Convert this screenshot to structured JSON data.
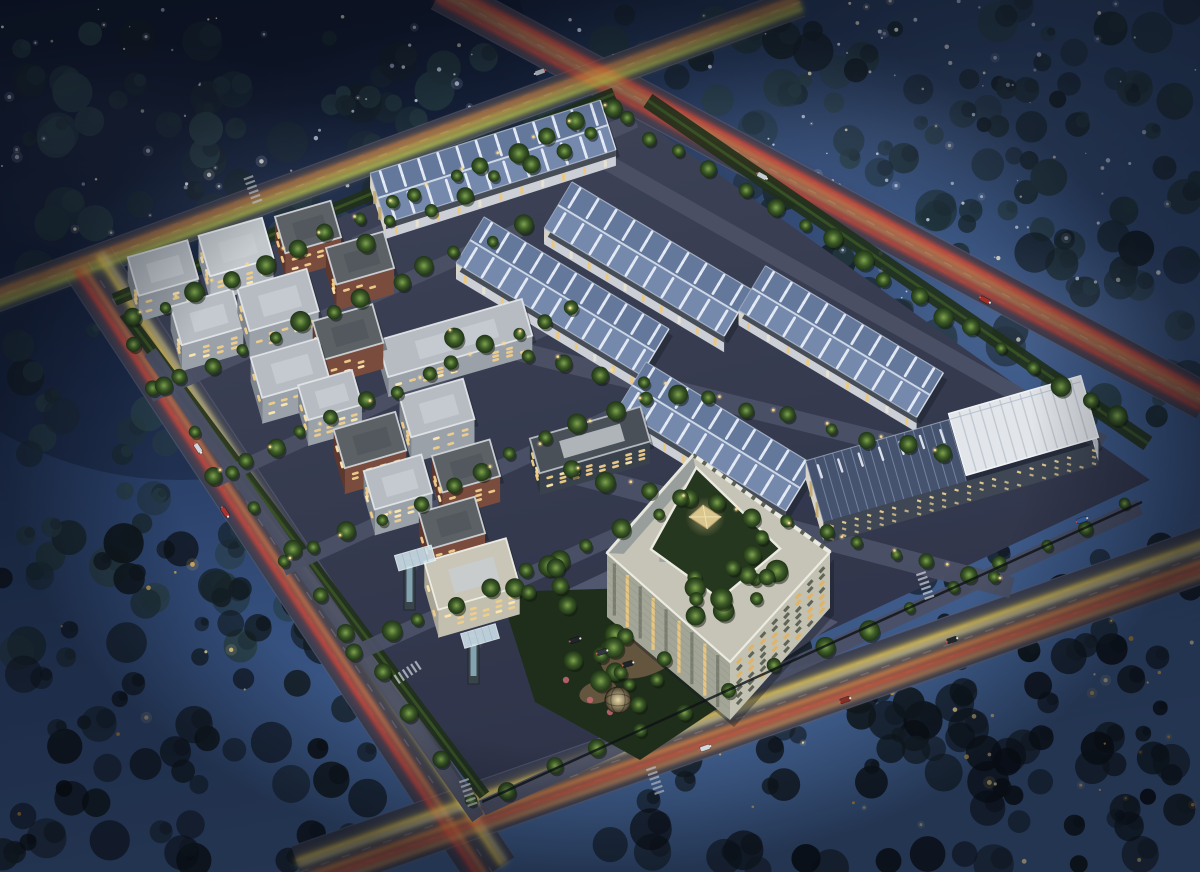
{
  "scene": {
    "kind": "aerial-night-rendering",
    "subject": "industrial-park-birdseye",
    "visible_text": []
  },
  "canvas": {
    "w": 1200,
    "h": 872
  },
  "seed": 20240711,
  "colors": {
    "skyStops": [
      [
        "0",
        "#101a2e"
      ],
      [
        "0.4",
        "#22355a"
      ],
      [
        "0.75",
        "#36517f"
      ],
      [
        "1",
        "#41608f"
      ]
    ],
    "forest0": [
      "#1b2a32",
      "#20333b",
      "#263c44",
      "#152027",
      "#2a4148"
    ],
    "forest1": [
      "#0c1216",
      "#10181d",
      "#141e24",
      "#0a0e12"
    ],
    "starCool": [
      "#ffffff",
      "#dde8fa",
      "#f6eed6",
      "#c6d5ee"
    ],
    "starWarm": [
      "#e8b85c",
      "#f6d98e",
      "#d49a3e",
      "#ffe9b0"
    ],
    "asphalt": "#3a3f52",
    "roadEdge": "#5d6278",
    "lane": "#9aa2b6",
    "siteA": "#3f4457",
    "siteB": "#2f344a",
    "innerRoad": "#4b5065",
    "plaza": "#535870",
    "verge": "#20301a",
    "hedge": "#3c5826",
    "parkGreen": "#1f2e1b",
    "path": "#6a5a42",
    "fRoofA": "#64789c",
    "fRoofB": "#7589ad",
    "ridge": "#ccd6e4",
    "skylight": "#e9eff8",
    "eave": "#aab6ca",
    "fWall": "#ccd0d6",
    "fBand": "#464d57",
    "fEnd": "#d8d3c8",
    "fWin": "#ecc87e",
    "endStrip": "#c2a871",
    "solarBase": "#46536e",
    "solarLine": "#9db1d0",
    "boxTop": "#e2e6ea",
    "boxRib": "#c2c9d2",
    "boxEdge": "#f0f3f5",
    "boxEnd": "#dde0e4",
    "boxEndRib": "#b4bac2",
    "solWall": "#3f4754",
    "solWin": "#e8cf96",
    "blockTypes": {
      "g": {
        "roof": "#b6bcc2",
        "wall": "#9aa1a9",
        "end": "#7e858d",
        "par": "#e2e5e8"
      },
      "gl": {
        "roof": "#c2c7cc",
        "wall": "#adb3ba",
        "end": "#8f969e",
        "par": "#eceff2"
      },
      "b": {
        "roof": "#5c6166",
        "wall": "#7a4c3e",
        "end": "#5e382e",
        "par": "#cfd3d6"
      },
      "c": {
        "roof": "#c9c6b8",
        "wall": "#c2bfae",
        "end": "#a8a596",
        "par": "#efeee6"
      },
      "d": {
        "roof": "#4a5058",
        "wall": "#39424c",
        "end": "#2c343c",
        "par": "#b9bec4"
      }
    },
    "win": "#f2cf8a",
    "winBright": "#ffe9b0",
    "offRoof": "#c6c4b6",
    "offPar": "#ecebe2",
    "offGray": "#989e9c",
    "offSE": "#c2c1b2",
    "offSW": "#a3a697",
    "offWinLit": "#e2b465",
    "offWinDim": "#5a6052",
    "court": "#26371f",
    "pyr": "#d9c58e",
    "pyrLine": "#b49d6a",
    "pyrHi": "#f0e2b0",
    "lamp": "#ffd98a",
    "shadow": "#171b22",
    "gateTower": "#39434a",
    "gateGlass": "#9cc3d4",
    "gateCanopy": "#cfe2ec",
    "domeIn": "#e8d9a8",
    "domeOut": "#4a3f2c",
    "flower": "#c76a72"
  },
  "mist": [
    [
      250,
      190,
      300,
      90,
      0.16
    ],
    [
      900,
      130,
      300,
      85,
      0.15
    ],
    [
      1060,
      320,
      210,
      80,
      0.2
    ],
    [
      420,
      330,
      260,
      80,
      0.12
    ],
    [
      120,
      110,
      220,
      70,
      0.1
    ]
  ],
  "forest_regions": [
    [
      0,
      30,
      640,
      340,
      95,
      0
    ],
    [
      620,
      0,
      1200,
      130,
      42,
      0
    ],
    [
      740,
      80,
      1200,
      440,
      88,
      0
    ],
    [
      0,
      330,
      310,
      660,
      45,
      0
    ],
    [
      0,
      540,
      470,
      872,
      80,
      1
    ],
    [
      590,
      545,
      1200,
      872,
      120,
      1
    ]
  ],
  "star_regions": [
    {
      "r": [
        0,
        0,
        430,
        240
      ],
      "n": 55,
      "warm": false
    },
    {
      "r": [
        430,
        0,
        760,
        110
      ],
      "n": 14,
      "warm": false
    },
    {
      "r": [
        760,
        0,
        1200,
        300
      ],
      "n": 88,
      "warm": false
    },
    {
      "r": [
        950,
        300,
        1200,
        430,
        0
      ],
      "n": 10,
      "warm": false
    },
    {
      "r": [
        700,
        620,
        1200,
        866
      ],
      "n": 36,
      "warm": true
    },
    {
      "r": [
        0,
        560,
        260,
        866
      ],
      "n": 10,
      "warm": true
    }
  ],
  "roads": [
    {
      "key": "ne",
      "a": [
        440,
        -8
      ],
      "b": [
        1205,
        402
      ],
      "w": 38,
      "trails": [
        [
          -9,
          "#ff4636",
          2.6
        ],
        [
          -4,
          "#ff8a44",
          2.2
        ],
        [
          2,
          "#ffb05a",
          1.8
        ],
        [
          8,
          "#e84430",
          2.6
        ]
      ]
    },
    {
      "key": "nw",
      "a": [
        800,
        2
      ],
      "b": [
        -12,
        300
      ],
      "w": 30,
      "trails": [
        [
          -7,
          "#cde04e",
          2.6
        ],
        [
          -1,
          "#ffd44e",
          2.2
        ],
        [
          5,
          "#ff9a42",
          2.2
        ]
      ]
    },
    {
      "key": "w",
      "a": [
        88,
        262
      ],
      "b": [
        492,
        872
      ],
      "w": 54,
      "trails": [
        [
          14,
          "#ff4636",
          2.6
        ],
        [
          7,
          "#ff8a44",
          2.2
        ],
        [
          -12,
          "#ffd94e",
          2.8
        ],
        [
          -17,
          "#fff0a8",
          1.6
        ]
      ]
    },
    {
      "key": "s",
      "a": [
        300,
        872
      ],
      "b": [
        1212,
        552
      ],
      "w": 54,
      "trails": [
        [
          -12,
          "#ffd94e",
          3.0
        ],
        [
          -7,
          "#fff2b2",
          1.8
        ],
        [
          6,
          "#ff9a42",
          2.6
        ],
        [
          13,
          "#ff5a36",
          2.4
        ],
        [
          19,
          "#ffb05a",
          1.8
        ]
      ]
    }
  ],
  "site": {
    "poly": [
      [
        618,
        103
      ],
      [
        1150,
        480
      ],
      [
        478,
        795
      ],
      [
        118,
        309
      ]
    ]
  },
  "verges": [
    {
      "a": [
        118,
        309
      ],
      "b": [
        618,
        103
      ],
      "off": -10,
      "w": 13
    },
    {
      "a": [
        118,
        318
      ],
      "b": [
        478,
        800
      ],
      "off": -8,
      "w": 12
    },
    {
      "a": [
        640,
        112
      ],
      "b": [
        1140,
        455
      ],
      "off": -14,
      "w": 16
    }
  ],
  "inner_roads": [
    [
      355,
      245,
      635,
      120,
      16
    ],
    [
      150,
      395,
      520,
      230,
      15
    ],
    [
      215,
      480,
      580,
      312,
      15
    ],
    [
      283,
      568,
      648,
      400,
      16
    ],
    [
      352,
      655,
      700,
      498,
      16
    ],
    [
      440,
      332,
      950,
      458,
      19
    ],
    [
      560,
      470,
      1012,
      588,
      21
    ],
    [
      562,
      137,
      1103,
      443,
      16
    ],
    [
      150,
      352,
      478,
      818,
      14
    ],
    [
      482,
      808,
      1140,
      507,
      16
    ]
  ],
  "plaza": [
    [
      520,
      612
    ],
    [
      660,
      546
    ],
    [
      838,
      622
    ],
    [
      700,
      716
    ]
  ],
  "park": {
    "poly": [
      [
        500,
        592
      ],
      [
        700,
        586
      ],
      [
        745,
        690
      ],
      [
        640,
        760
      ],
      [
        535,
        702
      ]
    ],
    "paths": [
      [
        640,
        655,
        40,
        22,
        -15
      ],
      [
        598,
        692,
        19,
        11,
        -15
      ]
    ],
    "flowers": [
      [
        590,
        700
      ],
      [
        610,
        712
      ],
      [
        566,
        680
      ]
    ]
  },
  "factories": [
    {
      "r1": [
        378,
        198
      ],
      "r2": [
        608,
        125
      ],
      "w": 52,
      "wall": 16
    },
    {
      "r1": [
        558,
        205
      ],
      "r2": [
        738,
        313
      ],
      "w": 54,
      "wall": 16
    },
    {
      "r1": [
        470,
        240
      ],
      "r2": [
        655,
        352
      ],
      "w": 54,
      "wall": 16
    },
    {
      "r1": [
        752,
        288
      ],
      "r2": [
        930,
        395
      ],
      "w": 52,
      "wall": 15
    },
    {
      "r1": [
        632,
        385
      ],
      "r2": [
        800,
        488
      ],
      "w": 54,
      "wall": 16
    }
  ],
  "solar": {
    "c": [
      952,
      452
    ],
    "L": 286,
    "W": 64,
    "wall": 22
  },
  "office": {
    "n": [
      693,
      455
    ],
    "e": [
      830,
      552
    ],
    "s": [
      730,
      662
    ],
    "w": [
      607,
      553
    ],
    "hS": 58,
    "hE": 56,
    "hW": 64
  },
  "blocks": [
    [
      163,
      268,
      62,
      40,
      "g"
    ],
    [
      236,
      247,
      66,
      42,
      "gl"
    ],
    [
      308,
      227,
      58,
      38,
      "b"
    ],
    [
      360,
      258,
      60,
      38,
      "b"
    ],
    [
      207,
      317,
      64,
      40,
      "g"
    ],
    [
      278,
      300,
      72,
      44,
      "g"
    ],
    [
      348,
      332,
      62,
      40,
      "b"
    ],
    [
      290,
      368,
      70,
      42,
      "g"
    ],
    [
      330,
      395,
      56,
      36,
      "g"
    ],
    [
      437,
      408,
      66,
      42,
      "g"
    ],
    [
      370,
      440,
      64,
      40,
      "b"
    ],
    [
      398,
      482,
      60,
      40,
      "g"
    ],
    [
      466,
      466,
      60,
      38,
      "b"
    ],
    [
      452,
      523,
      58,
      38,
      "b"
    ]
  ],
  "slabs": [
    {
      "c": [
        455,
        338
      ],
      "L": 150,
      "W": 38,
      "wall": 20,
      "type": "g"
    },
    {
      "c": [
        590,
        440
      ],
      "L": 115,
      "W": 36,
      "wall": 22,
      "type": "d"
    },
    {
      "c": [
        472,
        574
      ],
      "L": 85,
      "W": 50,
      "wall": 28,
      "type": "c"
    }
  ],
  "gates": [
    {
      "t": [
        404,
        560,
        11,
        50
      ],
      "canopy": [
        415,
        558,
        38,
        16
      ]
    },
    {
      "t": [
        468,
        638,
        11,
        46
      ],
      "canopy": [
        480,
        636,
        36,
        15
      ]
    }
  ],
  "dome": [
    618,
    700,
    13
  ],
  "tree_rows": [
    [
      150,
      390,
      520,
      228,
      13
    ],
    [
      215,
      472,
      575,
      305,
      13
    ],
    [
      285,
      562,
      645,
      395,
      12
    ],
    [
      355,
      650,
      690,
      495,
      11
    ],
    [
      135,
      318,
      610,
      108,
      16
    ],
    [
      655,
      135,
      1120,
      420,
      17
    ],
    [
      510,
      790,
      1130,
      505,
      15
    ],
    [
      135,
      345,
      470,
      800,
      12
    ],
    [
      450,
      335,
      940,
      455,
      14
    ],
    [
      575,
      470,
      1000,
      580,
      13
    ],
    [
      360,
      240,
      630,
      118,
      9
    ]
  ],
  "tree_clusters": [
    [
      615,
      675,
      60,
      13
    ],
    [
      725,
      600,
      48,
      8
    ],
    [
      540,
      590,
      36,
      6
    ],
    [
      760,
      560,
      40,
      6
    ]
  ],
  "lamp_rows": [
    [
      140,
      312,
      605,
      105,
      14
    ],
    [
      450,
      330,
      935,
      450,
      10
    ],
    [
      578,
      468,
      1000,
      578,
      9
    ],
    [
      220,
      470,
      570,
      308,
      8
    ],
    [
      290,
      558,
      640,
      398,
      8
    ]
  ],
  "cars": [
    [
      198,
      448,
      "#cfd4da",
      "w"
    ],
    [
      225,
      512,
      "#a83430",
      "w"
    ],
    [
      705,
      748,
      "#d8dde2",
      "s"
    ],
    [
      845,
      700,
      "#8a2f28",
      "s"
    ],
    [
      1082,
      520,
      "#3a66b0",
      "s"
    ],
    [
      952,
      640,
      "#23282e",
      "s"
    ],
    [
      985,
      300,
      "#a03028",
      "ne"
    ],
    [
      762,
      176,
      "#c8ccd2",
      "ne"
    ],
    [
      540,
      72,
      "#c8ccd2",
      "nw"
    ],
    [
      575,
      640,
      "#22262c",
      "p"
    ],
    [
      602,
      652,
      "#31363c",
      "p"
    ],
    [
      628,
      664,
      "#1f242a",
      "p"
    ]
  ],
  "crosswalks": [
    [
      468,
      792,
      "s"
    ],
    [
      655,
      780,
      "s"
    ],
    [
      925,
      585,
      "s"
    ],
    [
      408,
      672,
      "w"
    ],
    [
      253,
      190,
      "nw"
    ]
  ],
  "fence": {
    "a": [
      482,
      802
    ],
    "b": [
      1142,
      502
    ]
  }
}
